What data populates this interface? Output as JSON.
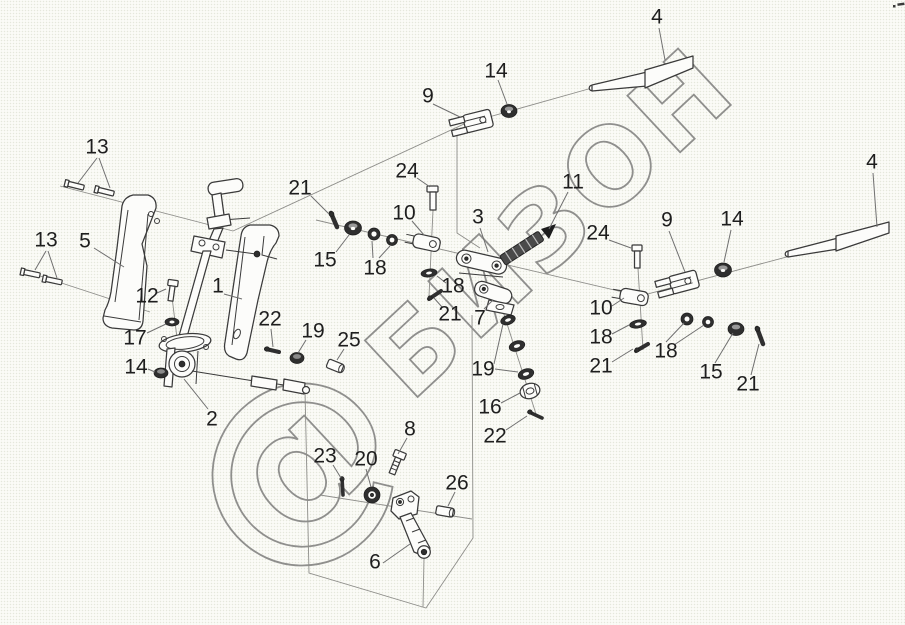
{
  "page": {
    "width": 905,
    "height": 625,
    "kind": "exploded-parts-diagram"
  },
  "colors": {
    "background": "#fbfbf7",
    "part_line": "#3a3a3a",
    "leader_line": "#6f6f6f",
    "callout_text": "#1e1e1e",
    "watermark": "#8f8f8d"
  },
  "watermark": {
    "logo": "@",
    "text": "БИЗОН"
  },
  "callouts": [
    {
      "n": "13",
      "x": 97,
      "y": 147,
      "leaders": [
        [
          97,
          158,
          78,
          183
        ],
        [
          99,
          158,
          110,
          188
        ]
      ]
    },
    {
      "n": "13",
      "x": 46,
      "y": 240,
      "leaders": [
        [
          46,
          251,
          35,
          270
        ],
        [
          48,
          251,
          57,
          278
        ]
      ]
    },
    {
      "n": "5",
      "x": 85,
      "y": 241,
      "leaders": [
        [
          94,
          248,
          124,
          267
        ]
      ]
    },
    {
      "n": "12",
      "x": 147,
      "y": 296,
      "leaders": [
        [
          157,
          293,
          166,
          289
        ]
      ]
    },
    {
      "n": "17",
      "x": 135,
      "y": 338,
      "leaders": [
        [
          147,
          333,
          166,
          324
        ]
      ]
    },
    {
      "n": "14",
      "x": 136,
      "y": 367,
      "leaders": [
        [
          148,
          369,
          155,
          372
        ]
      ]
    },
    {
      "n": "1",
      "x": 218,
      "y": 286,
      "leaders": [
        [
          224,
          294,
          242,
          299
        ]
      ]
    },
    {
      "n": "22",
      "x": 270,
      "y": 319,
      "leaders": [
        [
          271,
          329,
          273,
          347
        ]
      ]
    },
    {
      "n": "19",
      "x": 313,
      "y": 331,
      "leaders": [
        [
          306,
          340,
          298,
          353
        ]
      ]
    },
    {
      "n": "25",
      "x": 349,
      "y": 340,
      "leaders": [
        [
          344,
          349,
          337,
          360
        ]
      ]
    },
    {
      "n": "2",
      "x": 212,
      "y": 419,
      "leaders": [
        [
          208,
          409,
          184,
          379
        ]
      ]
    },
    {
      "n": "21",
      "x": 300,
      "y": 188,
      "leaders": [
        [
          311,
          196,
          329,
          214
        ]
      ]
    },
    {
      "n": "15",
      "x": 325,
      "y": 260,
      "leaders": [
        [
          336,
          252,
          349,
          235
        ]
      ]
    },
    {
      "n": "18",
      "x": 375,
      "y": 268,
      "leaders": [
        [
          373,
          258,
          372,
          241
        ],
        [
          379,
          258,
          390,
          246
        ]
      ]
    },
    {
      "n": "10",
      "x": 404,
      "y": 213,
      "leaders": [
        [
          412,
          221,
          424,
          235
        ]
      ]
    },
    {
      "n": "24",
      "x": 407,
      "y": 171,
      "leaders": [
        [
          417,
          178,
          430,
          187
        ]
      ]
    },
    {
      "n": "3",
      "x": 478,
      "y": 217,
      "leaders": [
        [
          480,
          228,
          488,
          252
        ]
      ]
    },
    {
      "n": "11",
      "x": 573,
      "y": 182,
      "leaders": [
        [
          568,
          192,
          549,
          229
        ]
      ]
    },
    {
      "n": "18",
      "x": 453,
      "y": 286,
      "leaders": [
        [
          446,
          283,
          437,
          276
        ]
      ]
    },
    {
      "n": "21",
      "x": 450,
      "y": 314,
      "leaders": [
        [
          442,
          307,
          434,
          298
        ]
      ]
    },
    {
      "n": "7",
      "x": 480,
      "y": 318,
      "leaders": [
        [
          484,
          309,
          493,
          300
        ]
      ]
    },
    {
      "n": "19",
      "x": 483,
      "y": 369,
      "leaders": [
        [
          494,
          364,
          503,
          324
        ],
        [
          495,
          369,
          518,
          372
        ]
      ]
    },
    {
      "n": "16",
      "x": 490,
      "y": 407,
      "leaders": [
        [
          501,
          403,
          520,
          393
        ]
      ]
    },
    {
      "n": "22",
      "x": 495,
      "y": 436,
      "leaders": [
        [
          506,
          430,
          527,
          416
        ]
      ]
    },
    {
      "n": "9",
      "x": 428,
      "y": 96,
      "leaders": [
        [
          433,
          104,
          460,
          117
        ]
      ]
    },
    {
      "n": "14",
      "x": 496,
      "y": 71,
      "leaders": [
        [
          498,
          80,
          507,
          104
        ]
      ]
    },
    {
      "n": "4",
      "x": 657,
      "y": 17,
      "leaders": [
        [
          659,
          28,
          665,
          60
        ]
      ]
    },
    {
      "n": "4",
      "x": 872,
      "y": 162,
      "leaders": [
        [
          873,
          173,
          877,
          227
        ]
      ]
    },
    {
      "n": "24",
      "x": 598,
      "y": 233,
      "leaders": [
        [
          609,
          240,
          631,
          248
        ]
      ]
    },
    {
      "n": "9",
      "x": 667,
      "y": 220,
      "leaders": [
        [
          669,
          231,
          685,
          272
        ]
      ]
    },
    {
      "n": "14",
      "x": 732,
      "y": 219,
      "leaders": [
        [
          731,
          230,
          724,
          262
        ]
      ]
    },
    {
      "n": "10",
      "x": 601,
      "y": 308,
      "leaders": [
        [
          612,
          306,
          624,
          298
        ]
      ]
    },
    {
      "n": "18",
      "x": 601,
      "y": 337,
      "leaders": [
        [
          612,
          334,
          629,
          325
        ]
      ]
    },
    {
      "n": "21",
      "x": 601,
      "y": 366,
      "leaders": [
        [
          612,
          362,
          633,
          349
        ]
      ]
    },
    {
      "n": "18",
      "x": 666,
      "y": 351,
      "leaders": [
        [
          666,
          342,
          684,
          323
        ],
        [
          674,
          345,
          704,
          325
        ]
      ]
    },
    {
      "n": "15",
      "x": 711,
      "y": 372,
      "leaders": [
        [
          715,
          363,
          733,
          333
        ]
      ]
    },
    {
      "n": "21",
      "x": 748,
      "y": 384,
      "leaders": [
        [
          751,
          375,
          759,
          344
        ]
      ]
    },
    {
      "n": "8",
      "x": 410,
      "y": 429,
      "leaders": [
        [
          407,
          438,
          398,
          454
        ]
      ]
    },
    {
      "n": "23",
      "x": 325,
      "y": 456,
      "leaders": [
        [
          333,
          465,
          341,
          478
        ]
      ]
    },
    {
      "n": "20",
      "x": 366,
      "y": 459,
      "leaders": [
        [
          366,
          469,
          371,
          487
        ]
      ]
    },
    {
      "n": "26",
      "x": 457,
      "y": 483,
      "leaders": [
        [
          455,
          492,
          448,
          506
        ]
      ]
    },
    {
      "n": "6",
      "x": 375,
      "y": 562,
      "leaders": [
        [
          383,
          563,
          410,
          544
        ]
      ]
    }
  ]
}
